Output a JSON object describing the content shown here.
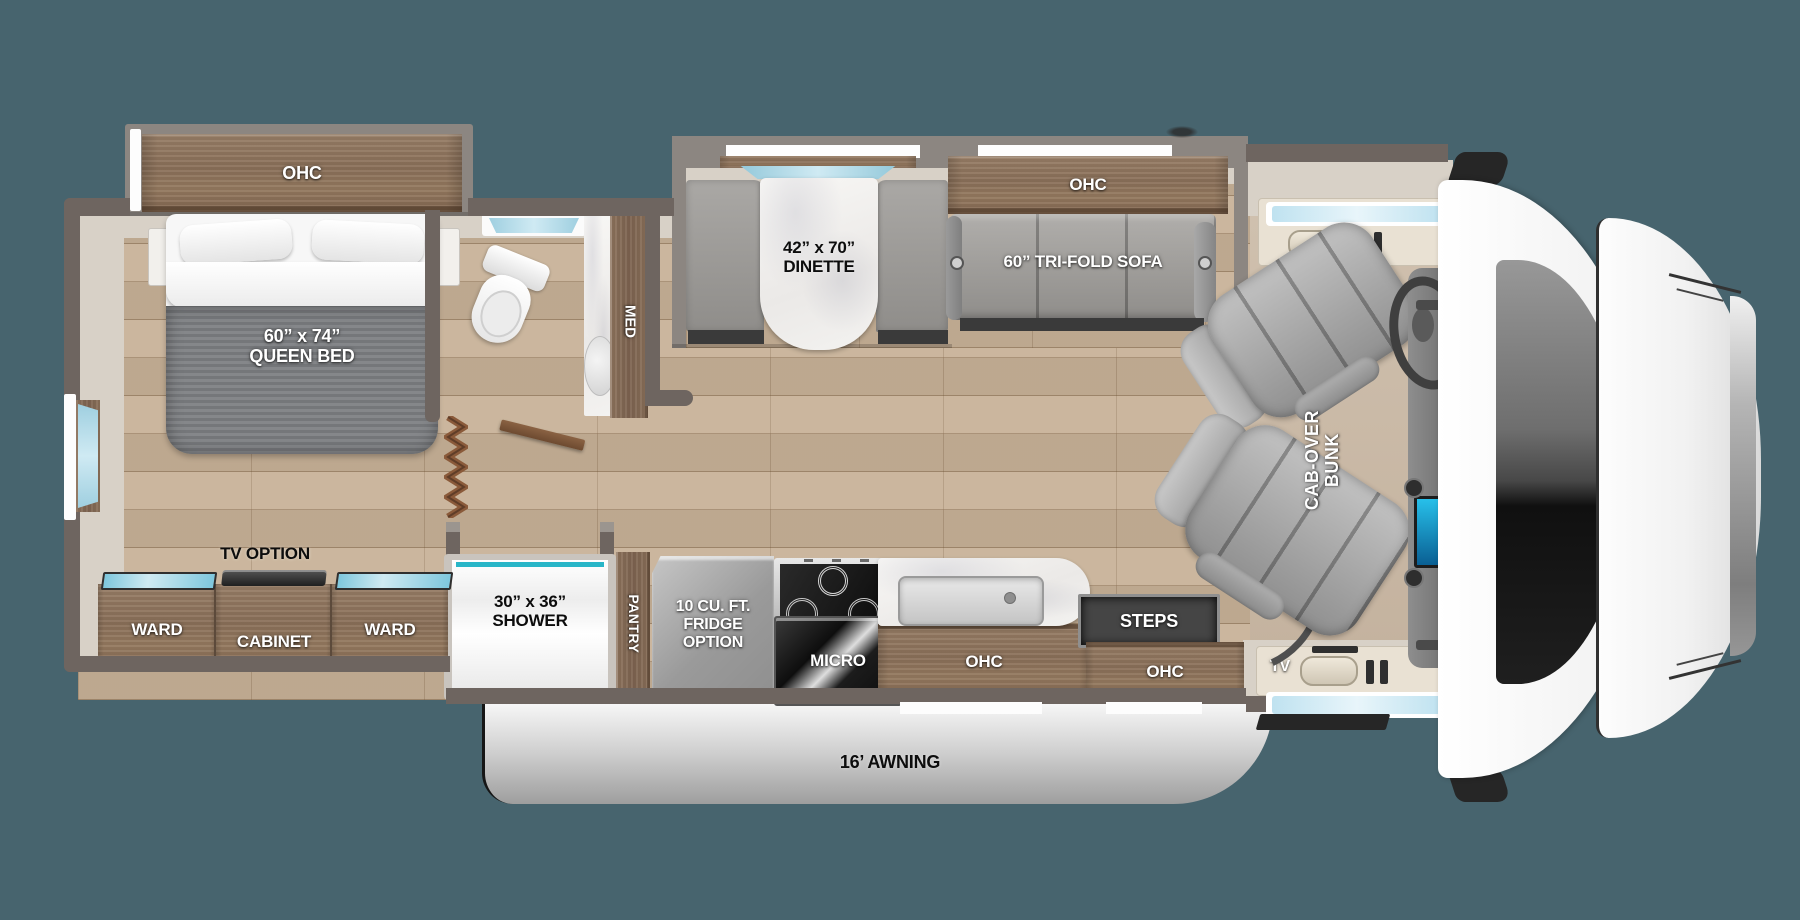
{
  "scene": {
    "width": 1800,
    "height": 920,
    "background": "#47646e",
    "kind": "rv-floor-plan"
  },
  "colors": {
    "body_wall": "#6e6560",
    "slide_wall": "#8c8681",
    "cabinet_wood": "#8a7059",
    "floor_wood": "#c7b197",
    "cab_floor": "#c9b8a6",
    "accent_teal": "#29b6c8",
    "window_glass": "#bfe2f0",
    "awning_gray": "#c9c9c9",
    "label_white": "#ffffff",
    "label_black": "#0d0d0d"
  },
  "bedroom": {
    "ohc": "OHC",
    "bed_size": "60” x 74”",
    "bed_name": "QUEEN BED",
    "tv_option": "TV OPTION",
    "ward_left": "WARD",
    "cabinet": "CABINET",
    "ward_right": "WARD"
  },
  "bathroom": {
    "med": "MED",
    "shower_size": "30” x 36”",
    "shower_name": "SHOWER"
  },
  "kitchen": {
    "pantry": "PANTRY",
    "fridge_line1": "10 CU. FT.",
    "fridge_line2": "FRIDGE",
    "fridge_line3": "OPTION",
    "micro": "MICRO",
    "ohc": "OHC"
  },
  "living": {
    "dinette_size": "42” x 70”",
    "dinette_name": "DINETTE",
    "ohc": "OHC",
    "sofa": "60” TRI-FOLD SOFA"
  },
  "entry": {
    "steps": "STEPS",
    "ohc": "OHC",
    "tv": "TV"
  },
  "cab": {
    "bunk_line1": "CAB-OVER",
    "bunk_line2": "BUNK"
  },
  "exterior": {
    "awning": "16’ AWNING"
  }
}
